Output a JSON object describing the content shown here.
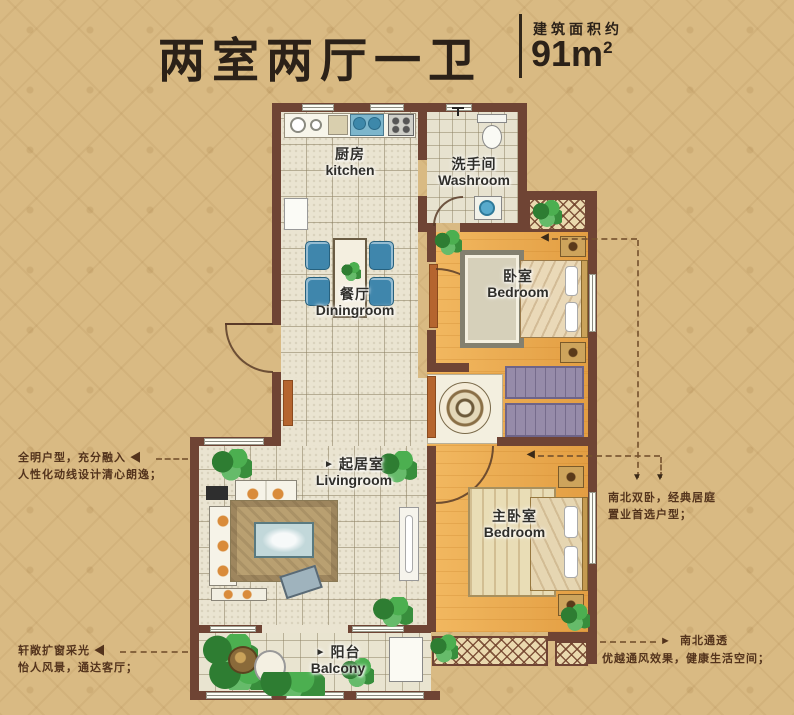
{
  "header": {
    "title": "两室两厅一卫",
    "area_label": "建筑面积约",
    "area_value": "91m",
    "area_sup": "2"
  },
  "rooms": {
    "kitchen": {
      "zh": "厨房",
      "en": "kitchen"
    },
    "washroom": {
      "zh": "洗手间",
      "en": "Washroom"
    },
    "dining": {
      "zh": "餐厅",
      "en": "Diningroom"
    },
    "bedroom_north": {
      "zh": "卧室",
      "en": "Bedroom"
    },
    "living": {
      "zh": "起居室",
      "en": "Livingroom",
      "arrow": "►"
    },
    "bedroom_master": {
      "zh": "主卧室",
      "en": "Bedroom"
    },
    "balcony": {
      "zh": "阳台",
      "en": "Balcony",
      "arrow": "►"
    }
  },
  "annotations": {
    "left_top": {
      "line1": "全明户型，充分融入",
      "arrow": "◀",
      "line2": "人性化动线设计清心朗逸；"
    },
    "left_bottom": {
      "line1": "轩敞扩窗采光",
      "arrow": "◀",
      "line2": "怡人风景，通达客厅；"
    },
    "right_top": {
      "line1": "南北双卧，经典居庭",
      "line2": "置业首选户型；",
      "arrow1": "▼",
      "arrow2": "▼",
      "pointer1": "◀",
      "pointer2": "◀"
    },
    "right_bottom": {
      "arrow": "►",
      "line1": "南北通透",
      "line2": "优越通风效果，健康生活空间；"
    }
  },
  "colors": {
    "background": "#d9ba83",
    "wall": "#6f4434",
    "tile_floor": "#eae4d1",
    "wood_floor": "#eaa94d",
    "door_accent": "#b5652f",
    "closet": "#968ba9",
    "annotation_text": "#53331c",
    "title_text": "#2b2118"
  }
}
